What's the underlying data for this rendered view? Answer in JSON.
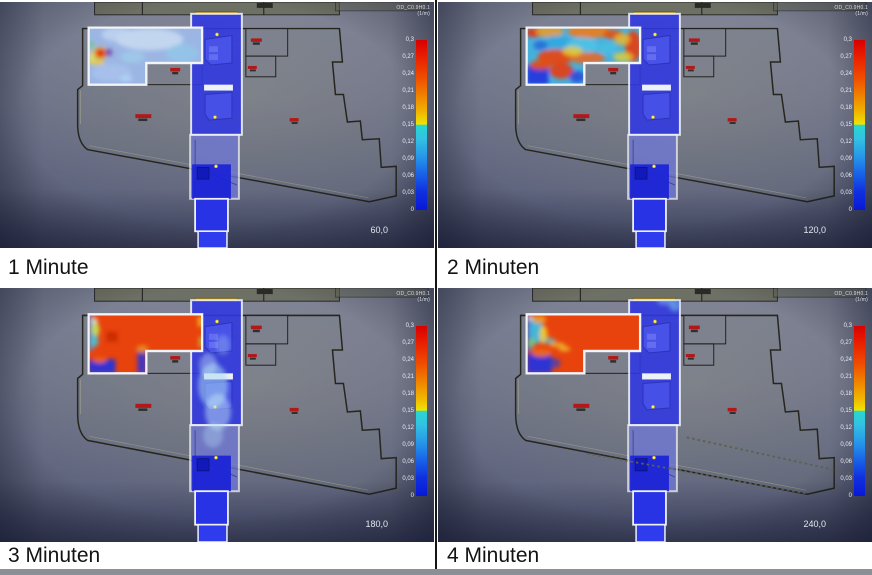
{
  "page": {
    "bottom_bar_color": "#8b9097",
    "divider_color": "#161616"
  },
  "colorbar": {
    "title_line1": "OD_C0.9H0.1",
    "title_line2": "(1/m)",
    "ticks": [
      "0,3",
      "0,27",
      "0,24",
      "0,21",
      "0,18",
      "0,15",
      "0,12",
      "0,09",
      "0,06",
      "0,03",
      "0"
    ]
  },
  "panels": [
    {
      "label": "1 Minute",
      "time": "60,0",
      "smoke": {
        "room_fill": "#9cb6e4",
        "dotted": "false",
        "patches": [
          {
            "t": "e",
            "x": 150,
            "y": 38,
            "rx": 34,
            "ry": 11,
            "f": "#cfe0f4",
            "o": 0.75
          },
          {
            "t": "e",
            "x": 118,
            "y": 33,
            "rx": 16,
            "ry": 7,
            "f": "#c2d6f0",
            "o": 0.8
          },
          {
            "t": "e",
            "x": 183,
            "y": 52,
            "rx": 16,
            "ry": 9,
            "f": "#8fcbe8",
            "o": 0.7
          },
          {
            "t": "e",
            "x": 133,
            "y": 56,
            "rx": 12,
            "ry": 6,
            "f": "#9ed4ea",
            "o": 0.6
          },
          {
            "t": "e",
            "x": 112,
            "y": 72,
            "rx": 20,
            "ry": 9,
            "f": "#aac4ee",
            "o": 0.7
          },
          {
            "t": "e",
            "x": 127,
            "y": 78,
            "rx": 6,
            "ry": 3,
            "f": "#bbeeff",
            "o": 0.5
          },
          {
            "t": "r",
            "x": 91,
            "y": 40,
            "w": 2.5,
            "h": 7,
            "f": "#5ad448",
            "o": 0.95
          },
          {
            "t": "e",
            "x": 101,
            "y": 52,
            "rx": 7,
            "ry": 6,
            "f": "#f0a018",
            "o": 0.9
          },
          {
            "t": "e",
            "x": 101,
            "y": 52,
            "rx": 4.5,
            "ry": 4,
            "f": "#e42808",
            "o": 1
          },
          {
            "t": "r",
            "x": 106,
            "y": 48,
            "w": 6.5,
            "h": 6.5,
            "f": "#6f43a8",
            "o": 0.9
          },
          {
            "t": "e",
            "x": 97,
            "y": 61,
            "rx": 8,
            "ry": 3,
            "f": "#f0cc30",
            "o": 0.85
          },
          {
            "t": "e",
            "x": 92,
            "y": 56,
            "rx": 3,
            "ry": 6,
            "f": "#f0e848",
            "o": 0.7
          }
        ],
        "corridor_patches": []
      }
    },
    {
      "label": "2 Minuten",
      "time": "120,0",
      "smoke": {
        "room_fill": "#46b0dc",
        "dotted": "false",
        "patches": [
          {
            "t": "e",
            "x": 96,
            "y": 31,
            "rx": 8,
            "ry": 5,
            "f": "#e83408",
            "o": 0.9
          },
          {
            "t": "e",
            "x": 112,
            "y": 30,
            "rx": 14,
            "ry": 6,
            "f": "#f09c20",
            "o": 0.85
          },
          {
            "t": "e",
            "x": 152,
            "y": 30,
            "rx": 22,
            "ry": 7,
            "f": "#f07c18",
            "o": 0.9
          },
          {
            "t": "e",
            "x": 176,
            "y": 33,
            "rx": 10,
            "ry": 5,
            "f": "#e84c10",
            "o": 0.85
          },
          {
            "t": "e",
            "x": 196,
            "y": 45,
            "rx": 8,
            "ry": 16,
            "f": "#e83c0c",
            "o": 0.9
          },
          {
            "t": "e",
            "x": 185,
            "y": 38,
            "rx": 8,
            "ry": 6,
            "f": "#f0b824",
            "o": 0.8
          },
          {
            "t": "e",
            "x": 120,
            "y": 42,
            "rx": 16,
            "ry": 8,
            "f": "#30a8e0",
            "o": 0.85
          },
          {
            "t": "e",
            "x": 145,
            "y": 44,
            "rx": 16,
            "ry": 8,
            "f": "#50c4e8",
            "o": 0.8
          },
          {
            "t": "e",
            "x": 170,
            "y": 47,
            "rx": 9,
            "ry": 6,
            "f": "#48c0e4",
            "o": 0.8
          },
          {
            "t": "e",
            "x": 103,
            "y": 44,
            "rx": 7,
            "ry": 5,
            "f": "#2064d8",
            "o": 0.8
          },
          {
            "t": "e",
            "x": 118,
            "y": 56,
            "rx": 18,
            "ry": 8,
            "f": "#e84410",
            "o": 0.92
          },
          {
            "t": "e",
            "x": 150,
            "y": 57,
            "rx": 18,
            "ry": 6,
            "f": "#f06418",
            "o": 0.85
          },
          {
            "t": "e",
            "x": 135,
            "y": 50,
            "rx": 10,
            "ry": 5,
            "f": "#f0cc28",
            "o": 0.8
          },
          {
            "t": "e",
            "x": 186,
            "y": 56,
            "rx": 10,
            "ry": 5,
            "f": "#f0d028",
            "o": 0.75
          },
          {
            "t": "r",
            "x": 89,
            "y": 64,
            "w": 22,
            "h": 20,
            "f": "#2434de",
            "o": 0.92
          },
          {
            "t": "e",
            "x": 103,
            "y": 64,
            "rx": 11,
            "ry": 5,
            "f": "#e84c10",
            "o": 0.9
          },
          {
            "t": "e",
            "x": 124,
            "y": 70,
            "rx": 12,
            "ry": 8,
            "f": "#e83c0c",
            "o": 0.9
          },
          {
            "t": "e",
            "x": 140,
            "y": 76,
            "rx": 8,
            "ry": 6,
            "f": "#2840d8",
            "o": 0.8
          }
        ],
        "corridor_patches": []
      }
    },
    {
      "label": "3 Minuten",
      "time": "180,0",
      "smoke": {
        "room_fill": "#e8430c",
        "dotted": "false",
        "patches": [
          {
            "t": "r",
            "x": 89,
            "y": 26,
            "w": 4,
            "h": 36,
            "f": "#4f9ae0",
            "o": 0.95
          },
          {
            "t": "e",
            "x": 95,
            "y": 33,
            "rx": 3,
            "ry": 4,
            "f": "#e8f4f8",
            "o": 0.8
          },
          {
            "t": "e",
            "x": 96,
            "y": 41,
            "rx": 4,
            "ry": 7,
            "f": "#c2e24e",
            "o": 0.95
          },
          {
            "t": "e",
            "x": 95,
            "y": 52,
            "rx": 4,
            "ry": 6,
            "f": "#48c4d8",
            "o": 0.9
          },
          {
            "t": "r",
            "x": 107,
            "y": 43,
            "w": 11,
            "h": 10,
            "f": "#cc2a06",
            "o": 1
          },
          {
            "t": "r",
            "x": 89,
            "y": 70,
            "w": 27,
            "h": 14,
            "f": "#2434de",
            "o": 0.95
          },
          {
            "t": "e",
            "x": 100,
            "y": 71,
            "rx": 7,
            "ry": 3,
            "f": "#f06418",
            "o": 0.9
          },
          {
            "t": "r",
            "x": 138,
            "y": 62,
            "w": 9,
            "h": 22,
            "f": "#2434de",
            "o": 0.85
          },
          {
            "t": "e",
            "x": 143,
            "y": 60,
            "rx": 6,
            "ry": 4,
            "f": "#f0a020",
            "o": 0.7
          },
          {
            "t": "r",
            "x": 199,
            "y": 28,
            "w": 4,
            "h": 10,
            "f": "#f0d028",
            "o": 0.85
          },
          {
            "t": "r",
            "x": 200,
            "y": 48,
            "w": 3,
            "h": 10,
            "f": "#bce24e",
            "o": 0.8
          }
        ],
        "corridor_patches": [
          {
            "t": "e",
            "x": 214,
            "y": 96,
            "rx": 15,
            "ry": 22,
            "f": "#a8d8f2",
            "o": 0.55
          },
          {
            "t": "e",
            "x": 219,
            "y": 122,
            "rx": 13,
            "ry": 18,
            "f": "#c2e4f6",
            "o": 0.5
          },
          {
            "t": "e",
            "x": 209,
            "y": 76,
            "rx": 9,
            "ry": 12,
            "f": "#cce8f8",
            "o": 0.4
          },
          {
            "t": "e",
            "x": 224,
            "y": 56,
            "rx": 7,
            "ry": 10,
            "f": "#b2dcf4",
            "o": 0.3
          },
          {
            "t": "e",
            "x": 214,
            "y": 145,
            "rx": 10,
            "ry": 12,
            "f": "#b8e0f4",
            "o": 0.35
          }
        ]
      }
    },
    {
      "label": "4 Minuten",
      "time": "240,0",
      "smoke": {
        "room_fill": "#e8430c",
        "dotted": "true",
        "patches": [
          {
            "t": "r",
            "x": 89,
            "y": 26,
            "w": 5,
            "h": 36,
            "f": "#3a7ae8",
            "o": 0.95
          },
          {
            "t": "e",
            "x": 99,
            "y": 42,
            "rx": 7,
            "ry": 13,
            "f": "#3cbce0",
            "o": 0.95
          },
          {
            "t": "e",
            "x": 106,
            "y": 46,
            "rx": 4,
            "ry": 9,
            "f": "#f0d028",
            "o": 0.9
          },
          {
            "t": "e",
            "x": 102,
            "y": 31,
            "rx": 7,
            "ry": 4,
            "f": "#f09c20",
            "o": 0.9
          },
          {
            "t": "e",
            "x": 94,
            "y": 54,
            "rx": 3,
            "ry": 5,
            "f": "#7ed048",
            "o": 0.9
          },
          {
            "t": "e",
            "x": 93,
            "y": 30,
            "rx": 2.5,
            "ry": 2.5,
            "f": "#e8f4f8",
            "o": 0.8
          },
          {
            "t": "e",
            "x": 112,
            "y": 52,
            "rx": 6,
            "ry": 3,
            "f": "#50c4c8",
            "o": 0.8
          },
          {
            "t": "e",
            "x": 120,
            "y": 56,
            "rx": 8,
            "ry": 2.5,
            "f": "#f0b028",
            "o": 0.85
          },
          {
            "t": "e",
            "x": 127,
            "y": 60,
            "rx": 6,
            "ry": 2.5,
            "f": "#eec434",
            "o": 0.8
          },
          {
            "t": "r",
            "x": 89,
            "y": 64,
            "w": 25,
            "h": 20,
            "f": "#2434de",
            "o": 0.95
          },
          {
            "t": "e",
            "x": 104,
            "y": 64,
            "rx": 10,
            "ry": 4,
            "f": "#f06c18",
            "o": 0.9
          },
          {
            "t": "e",
            "x": 117,
            "y": 74,
            "rx": 6,
            "ry": 5,
            "f": "#2840d8",
            "o": 0.7
          }
        ],
        "corridor_patches": [
          {
            "t": "e",
            "x": 238,
            "y": 17,
            "rx": 6,
            "ry": 6,
            "f": "#7cc8ea",
            "o": 0.55
          },
          {
            "t": "e",
            "x": 228,
            "y": 13,
            "rx": 8,
            "ry": 4,
            "f": "#a0d8f0",
            "o": 0.4
          }
        ]
      }
    }
  ]
}
